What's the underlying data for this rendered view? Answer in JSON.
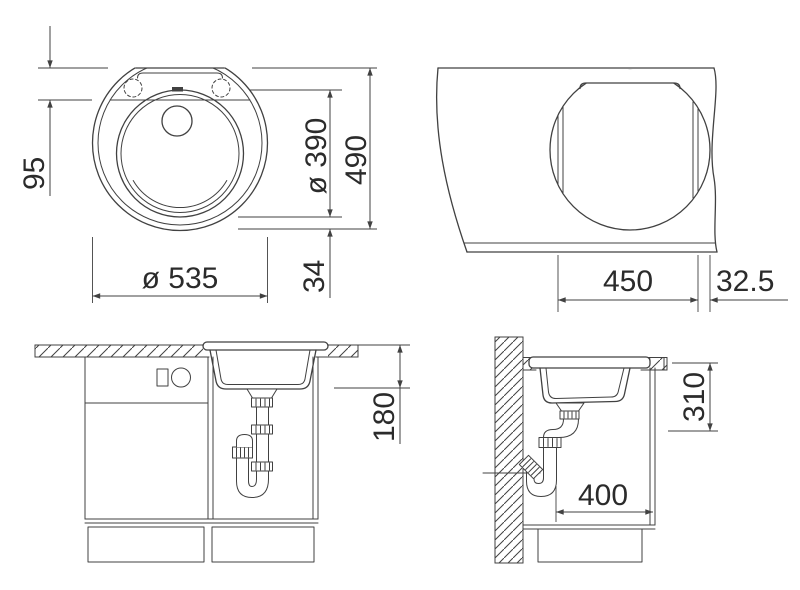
{
  "meta": {
    "drawing_type": "sink installation technical drawing",
    "views_count": 4
  },
  "colors": {
    "line": "#414141",
    "text": "#2b2b2b",
    "background": "#ffffff"
  },
  "views": {
    "top_view": {
      "label": "sink-top-view",
      "dimensions": {
        "ledge_depth": "95",
        "bowl_diameter": "ø 390",
        "overall_depth": "490",
        "front_rim_width": "34",
        "overall_diameter": "ø 535"
      }
    },
    "cutout_view": {
      "label": "worktop-cutout-view",
      "dimensions": {
        "cutout_width": "450",
        "front_edge_distance": "32.5"
      }
    },
    "front_view": {
      "label": "cabinet-front-view",
      "dimensions": {
        "bowl_depth": "180"
      }
    },
    "side_view": {
      "label": "cabinet-side-view",
      "dimensions": {
        "outlet_height": "310",
        "cabinet_clearance_depth": "400"
      }
    }
  }
}
